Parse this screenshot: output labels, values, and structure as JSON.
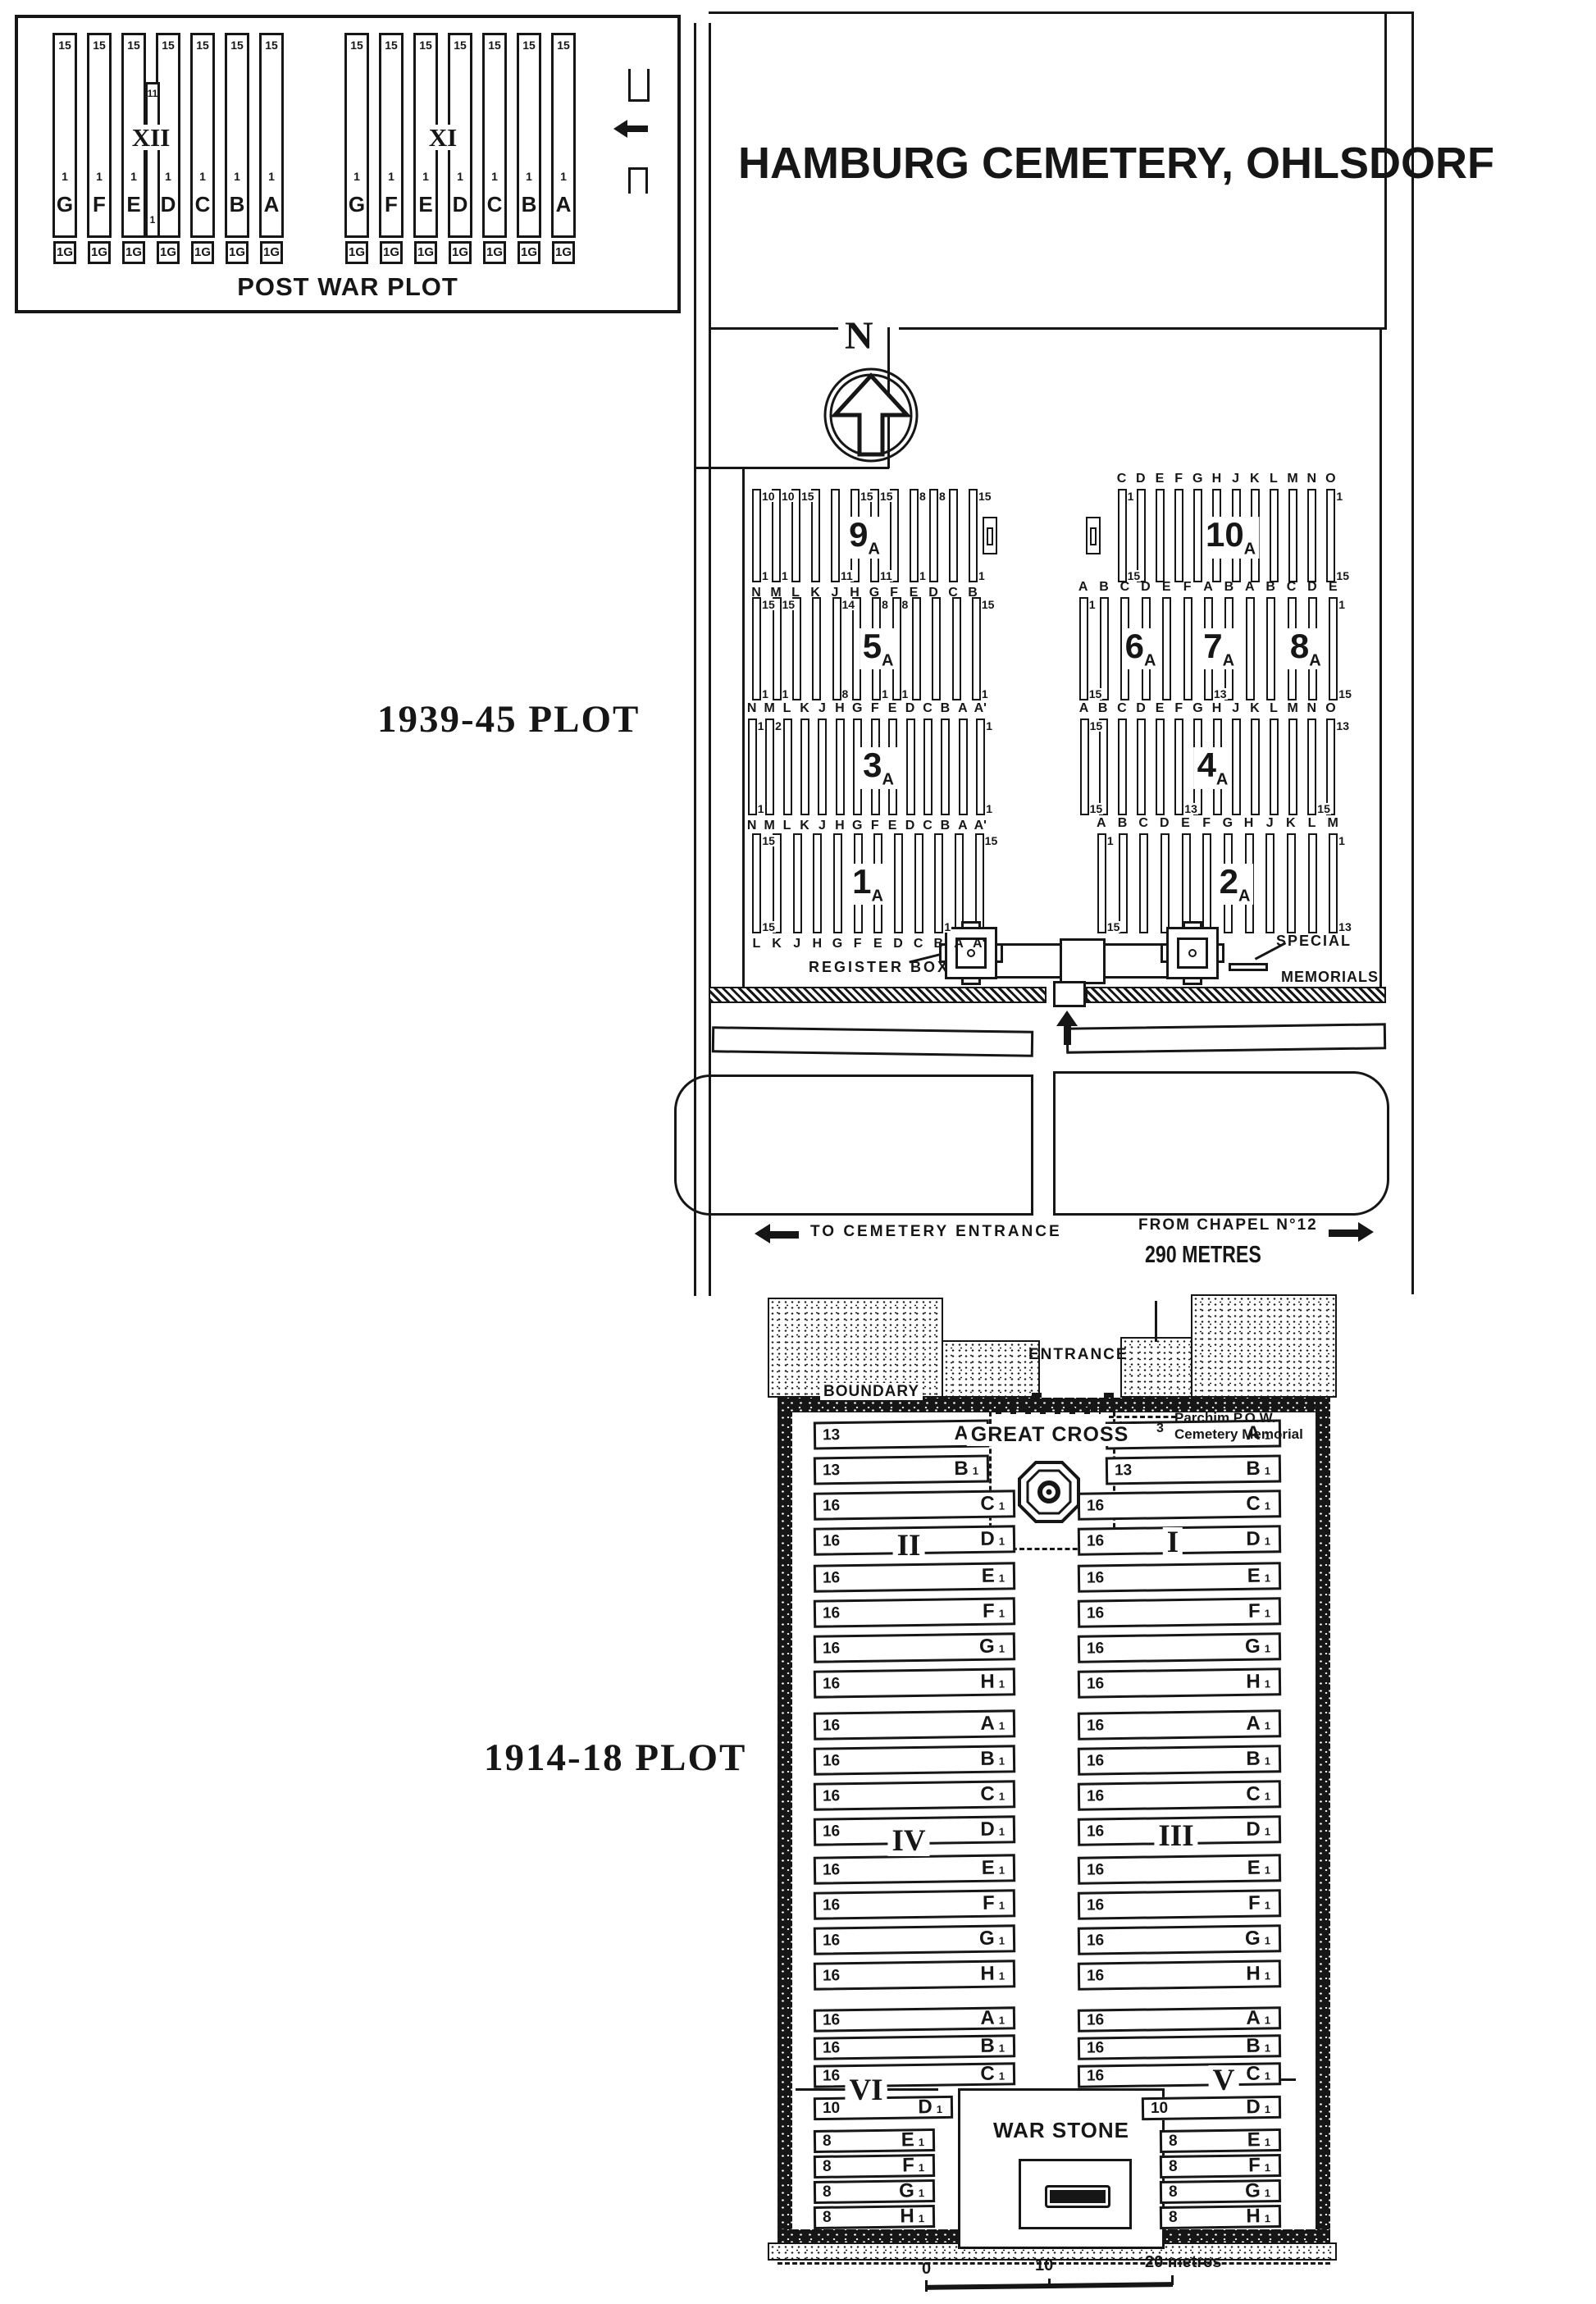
{
  "title": "HAMBURG CEMETERY, OHLSDORF",
  "ink": "#161616",
  "post_war_plot": {
    "caption": "POST WAR PLOT",
    "col_top": "15",
    "col_mid": "1",
    "col_foot": "1G",
    "letters": [
      "G",
      "F",
      "E",
      "D",
      "C",
      "B",
      "A"
    ],
    "groups": [
      {
        "numeral": "XII",
        "short_strip": {
          "top": "11",
          "bottom": "1"
        }
      },
      {
        "numeral": "XI"
      }
    ]
  },
  "compass": {
    "label": "N"
  },
  "plot_3945": {
    "label": "1939-45 PLOT",
    "register_box": "REGISTER BOX",
    "special_1": "SPECIAL",
    "special_2": "MEMORIALS",
    "sections": [
      {
        "key": "9A",
        "labels": [
          {
            "num": "9",
            "sub": "A"
          }
        ],
        "strips": 12,
        "letters_below": [
          "N",
          "M",
          "L",
          "K",
          "J",
          "H",
          "G",
          "F",
          "E",
          "D",
          "C",
          "B"
        ],
        "nums_top": [
          "10",
          "10",
          "15",
          "",
          "",
          "15",
          "15",
          "",
          "8",
          "8",
          "",
          "15"
        ],
        "nums_bottom": [
          "1",
          "1",
          "",
          "",
          "11",
          "",
          "11",
          "",
          "1",
          "",
          "",
          "1"
        ]
      },
      {
        "key": "10A",
        "labels": [
          {
            "num": "10",
            "sub": "A"
          }
        ],
        "strips": 12,
        "letters_above": [
          "C",
          "D",
          "E",
          "F",
          "G",
          "H",
          "J",
          "K",
          "L",
          "M",
          "N",
          "O"
        ],
        "nums_top": [
          "1",
          "",
          "",
          "",
          "",
          "",
          "",
          "",
          "",
          "",
          "",
          "1"
        ],
        "nums_bottom": [
          "15",
          "",
          "",
          "",
          "",
          "",
          "",
          "",
          "",
          "",
          "",
          "15"
        ]
      },
      {
        "key": "5A",
        "labels": [
          {
            "num": "5",
            "sub": "A"
          }
        ],
        "strips": 12,
        "nums_top": [
          "15",
          "15",
          "",
          "",
          "14",
          "",
          "8",
          "8",
          "",
          "",
          "",
          "15"
        ],
        "nums_bottom": [
          "1",
          "1",
          "",
          "",
          "8",
          "",
          "1",
          "1",
          "",
          "",
          "",
          "1"
        ]
      },
      {
        "key": "68A",
        "labels": [
          {
            "num": "6",
            "sub": "A"
          },
          {
            "num": "7",
            "sub": "A"
          },
          {
            "num": "8",
            "sub": "A"
          }
        ],
        "strips": 13,
        "letters_above": [
          "A",
          "B",
          "C",
          "D",
          "E",
          "F",
          "A",
          "B",
          "A",
          "B",
          "C",
          "D",
          "E"
        ],
        "nums_top": [
          "1",
          "",
          "",
          "",
          "",
          "",
          "",
          "",
          "",
          "",
          "",
          "",
          "1"
        ],
        "nums_bottom": [
          "15",
          "",
          "",
          "",
          "",
          "",
          "13",
          "",
          "",
          "",
          "",
          "",
          "15"
        ]
      },
      {
        "key": "3A",
        "labels": [
          {
            "num": "3",
            "sub": "A"
          }
        ],
        "strips": 14,
        "letters_above": [
          "N",
          "M",
          "L",
          "K",
          "J",
          "H",
          "G",
          "F",
          "E",
          "D",
          "C",
          "B",
          "A",
          "A'"
        ],
        "letters_below": [
          "N",
          "M",
          "L",
          "K",
          "J",
          "H",
          "G",
          "F",
          "E",
          "D",
          "C",
          "B",
          "A",
          "A'"
        ],
        "nums_top": [
          "1",
          "2",
          "",
          "",
          "",
          "",
          "",
          "",
          "",
          "",
          "",
          "",
          "",
          "1"
        ],
        "nums_bottom": [
          "1",
          "",
          "",
          "",
          "",
          "",
          "",
          "",
          "",
          "",
          "",
          "",
          "",
          "1"
        ]
      },
      {
        "key": "4A",
        "labels": [
          {
            "num": "4",
            "sub": "A"
          }
        ],
        "strips": 14,
        "letters_above": [
          "A",
          "B",
          "C",
          "D",
          "E",
          "F",
          "G",
          "H",
          "J",
          "K",
          "L",
          "M",
          "N",
          "O"
        ],
        "nums_top": [
          "15",
          "",
          "",
          "",
          "",
          "",
          "",
          "",
          "",
          "",
          "",
          "",
          "",
          "13"
        ],
        "nums_bottom": [
          "15",
          "",
          "",
          "",
          "",
          "13",
          "",
          "",
          "",
          "",
          "",
          "",
          "15",
          ""
        ]
      },
      {
        "key": "1A",
        "labels": [
          {
            "num": "1",
            "sub": "A"
          }
        ],
        "strips": 12,
        "letters_below": [
          "L",
          "K",
          "J",
          "H",
          "G",
          "F",
          "E",
          "D",
          "C",
          "B",
          "A",
          "A'"
        ],
        "nums_top": [
          "15",
          "",
          "",
          "",
          "",
          "",
          "",
          "",
          "",
          "",
          "",
          "15"
        ],
        "nums_bottom": [
          "15",
          "",
          "",
          "",
          "",
          "",
          "",
          "",
          "",
          "1",
          "",
          ""
        ]
      },
      {
        "key": "2A",
        "labels": [
          {
            "num": "2",
            "sub": "A"
          }
        ],
        "strips": 12,
        "letters_above": [
          "A",
          "B",
          "C",
          "D",
          "E",
          "F",
          "G",
          "H",
          "J",
          "K",
          "L",
          "M"
        ],
        "nums_top": [
          "1",
          "",
          "",
          "",
          "",
          "",
          "",
          "",
          "",
          "",
          "",
          "1"
        ],
        "nums_bottom": [
          "15",
          "",
          "",
          "",
          "",
          "",
          "",
          "",
          "",
          "",
          "",
          "13"
        ]
      }
    ]
  },
  "roads": {
    "to_entrance": "TO CEMETERY ENTRANCE",
    "from_chapel": "FROM CHAPEL N°12",
    "distance": "290 METRES"
  },
  "plot_1418": {
    "label": "1914-18 PLOT",
    "entrance": "ENTRANCE",
    "boundary": "BOUNDARY",
    "great_cross": "GREAT CROSS",
    "memorial": {
      "num_a": "1",
      "num_b": "3",
      "line1": "Parchim P.O.W.",
      "line2": "Cemetery Memorial"
    },
    "war_stone": "WAR STONE",
    "row_suffix": "1",
    "groups": [
      {
        "left_numeral": "II",
        "right_numeral": "I",
        "rows": [
          {
            "letter": "A",
            "count": "13"
          },
          {
            "letter": "B",
            "count": "13"
          },
          {
            "letter": "C",
            "count": "16"
          },
          {
            "letter": "D",
            "count": "16"
          },
          {
            "letter": "E",
            "count": "16"
          },
          {
            "letter": "F",
            "count": "16"
          },
          {
            "letter": "G",
            "count": "16"
          },
          {
            "letter": "H",
            "count": "16"
          }
        ]
      },
      {
        "left_numeral": "IV",
        "right_numeral": "III",
        "rows": [
          {
            "letter": "A",
            "count": "16"
          },
          {
            "letter": "B",
            "count": "16"
          },
          {
            "letter": "C",
            "count": "16"
          },
          {
            "letter": "D",
            "count": "16"
          },
          {
            "letter": "E",
            "count": "16"
          },
          {
            "letter": "F",
            "count": "16"
          },
          {
            "letter": "G",
            "count": "16"
          },
          {
            "letter": "H",
            "count": "16"
          }
        ]
      },
      {
        "left_numeral": "VI",
        "right_numeral": "V",
        "rows": [
          {
            "letter": "A",
            "count": "16"
          },
          {
            "letter": "B",
            "count": "16"
          },
          {
            "letter": "C",
            "count": "16"
          },
          {
            "letter": "D",
            "count": "10"
          },
          {
            "letter": "E",
            "count": "8"
          },
          {
            "letter": "F",
            "count": "8"
          },
          {
            "letter": "G",
            "count": "8"
          },
          {
            "letter": "H",
            "count": "8"
          }
        ]
      }
    ]
  },
  "scale": {
    "t0": "0",
    "t1": "10",
    "t2": "20 metres"
  }
}
